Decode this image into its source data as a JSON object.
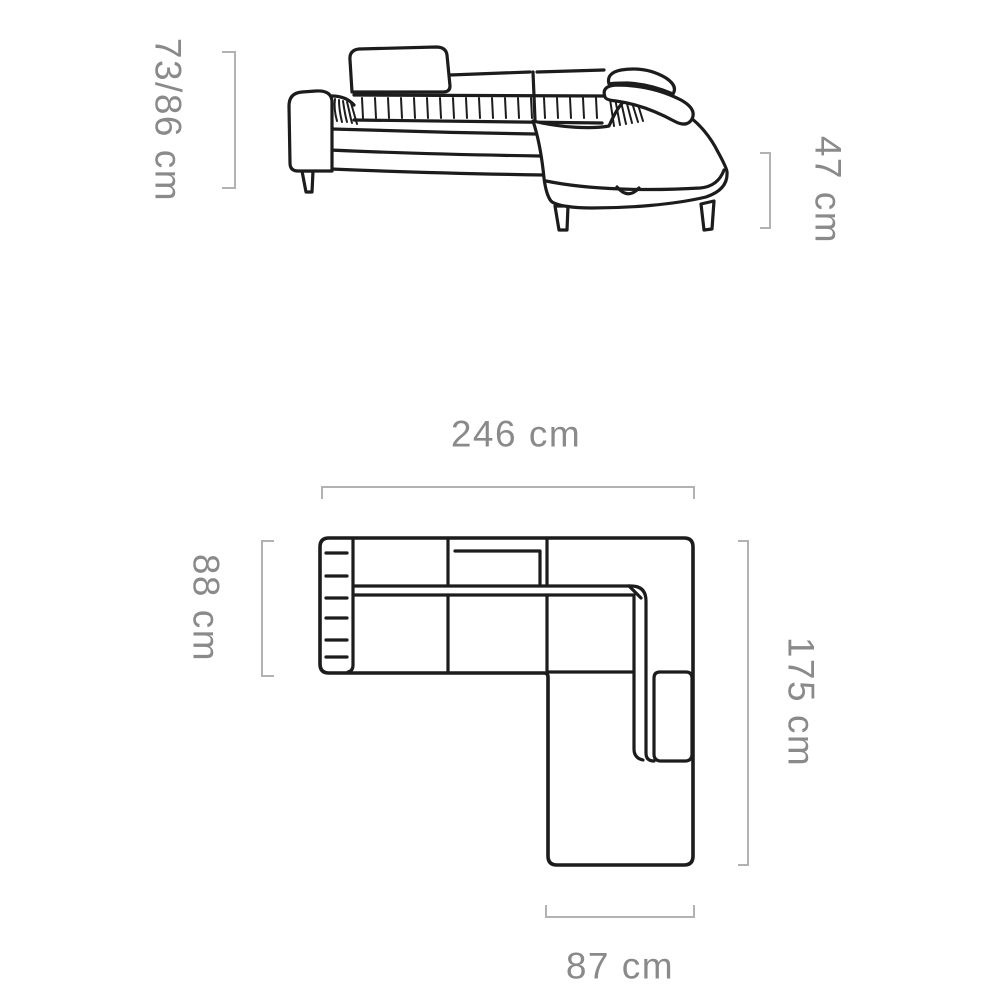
{
  "colors": {
    "line": "#1c1c1c",
    "dimension_line": "#b2b2b2",
    "dimension_text": "#8a8a8a",
    "background": "#ffffff"
  },
  "side_view": {
    "height_label": "73/86 cm",
    "seat_height_label": "47 cm"
  },
  "plan_view": {
    "width_label": "246 cm",
    "depth_label": "88 cm",
    "length_label": "175 cm",
    "chaise_width_label": "87 cm"
  }
}
